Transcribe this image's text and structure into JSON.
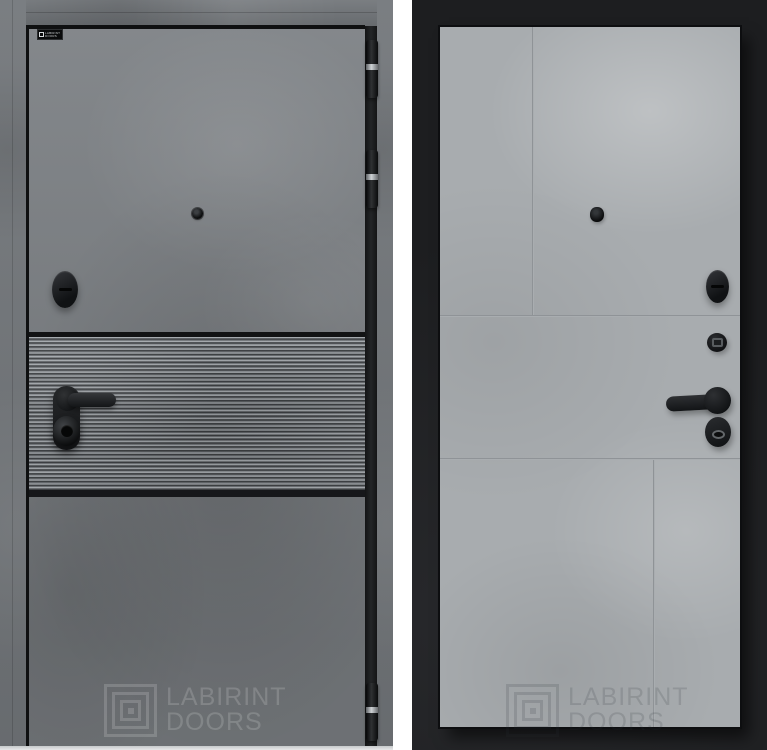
{
  "meta": {
    "description": "Product photo of a Labirint entrance door: exterior side in dark concrete with a fluted insert and interior side as a light concrete tiled panel on a black leaf"
  },
  "brand": {
    "name": "LABIRINT DOORS",
    "line1": "LABIRINT",
    "line2": "DOORS",
    "plate_line1": "LABIRINT",
    "plate_line2": "DOORS"
  },
  "icons": {
    "labyrinth-logo": "concentric-square-maze",
    "peephole": "black-circle",
    "thumbturn-knob": "black-oval-with-horizontal-slot",
    "door-handle": "black-lever-on-plate",
    "lock-cylinder": "black-round-cylinder",
    "wc-fixator": "black-round-with-square-insert",
    "keyhole-escutcheon": "black-oval-with-keyhole",
    "hinge": "black-barrel-with-steel-band"
  },
  "colors": {
    "background": "#ffffff",
    "exterior_concrete": "#7c8084",
    "exterior_frame": "#73777b",
    "fluted_trim": "#121314",
    "interior_background": "#1e1f21",
    "interior_panel": "#a8acaf",
    "hardware_black": "#1a1c1e",
    "watermark_light": "rgba(255,255,255,0.16)",
    "watermark_dark": "rgba(45,50,55,0.16)"
  }
}
